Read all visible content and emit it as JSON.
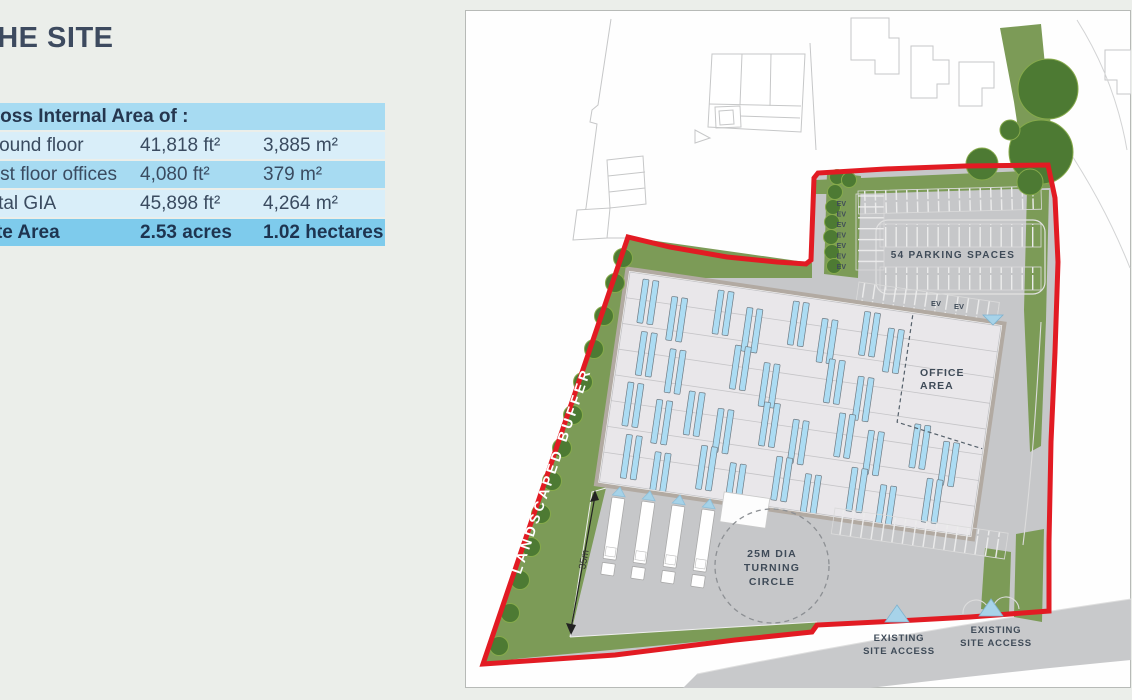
{
  "page": {
    "title": "THE SITE"
  },
  "table": {
    "header": "Gross Internal Area of :",
    "rows": [
      {
        "label": "Ground floor",
        "imperial": "41,818 ft²",
        "metric": "3,885 m²"
      },
      {
        "label": "First floor offices",
        "imperial": "4,080 ft²",
        "metric": "379 m²"
      },
      {
        "label": "Total GIA",
        "imperial": "45,898 ft²",
        "metric": "4,264 m²"
      }
    ],
    "site_row": {
      "label": "Site Area",
      "imperial": "2.53 acres",
      "metric": "1.02 hectares"
    }
  },
  "plan": {
    "parking_label": "54 PARKING SPACES",
    "ev": "EV",
    "office": [
      "OFFICE",
      "AREA"
    ],
    "circle": [
      "25M DIA",
      "TURNING",
      "CIRCLE"
    ],
    "access": [
      "EXISTING",
      "SITE ACCESS"
    ],
    "buffer_label": "LANDSCAPED BUFFER",
    "dimension_35m": "35m"
  },
  "colors": {
    "red_boundary": "#E21B23",
    "olive_green": "#7C9B57",
    "tree_green": "#4D7A33",
    "rooflight_blue": "#ACDCF3",
    "paved_gray": "#C6C7C9",
    "building_fill": "#E9E7EA",
    "building_band": "#B2AAA2",
    "table_blue_light": "#D9EEF9",
    "table_blue_mid": "#A7DBF2",
    "table_blue_strong": "#7ECBEC",
    "heading_navy": "#3D4A5F",
    "marker_blue": "#A7D3E9"
  }
}
